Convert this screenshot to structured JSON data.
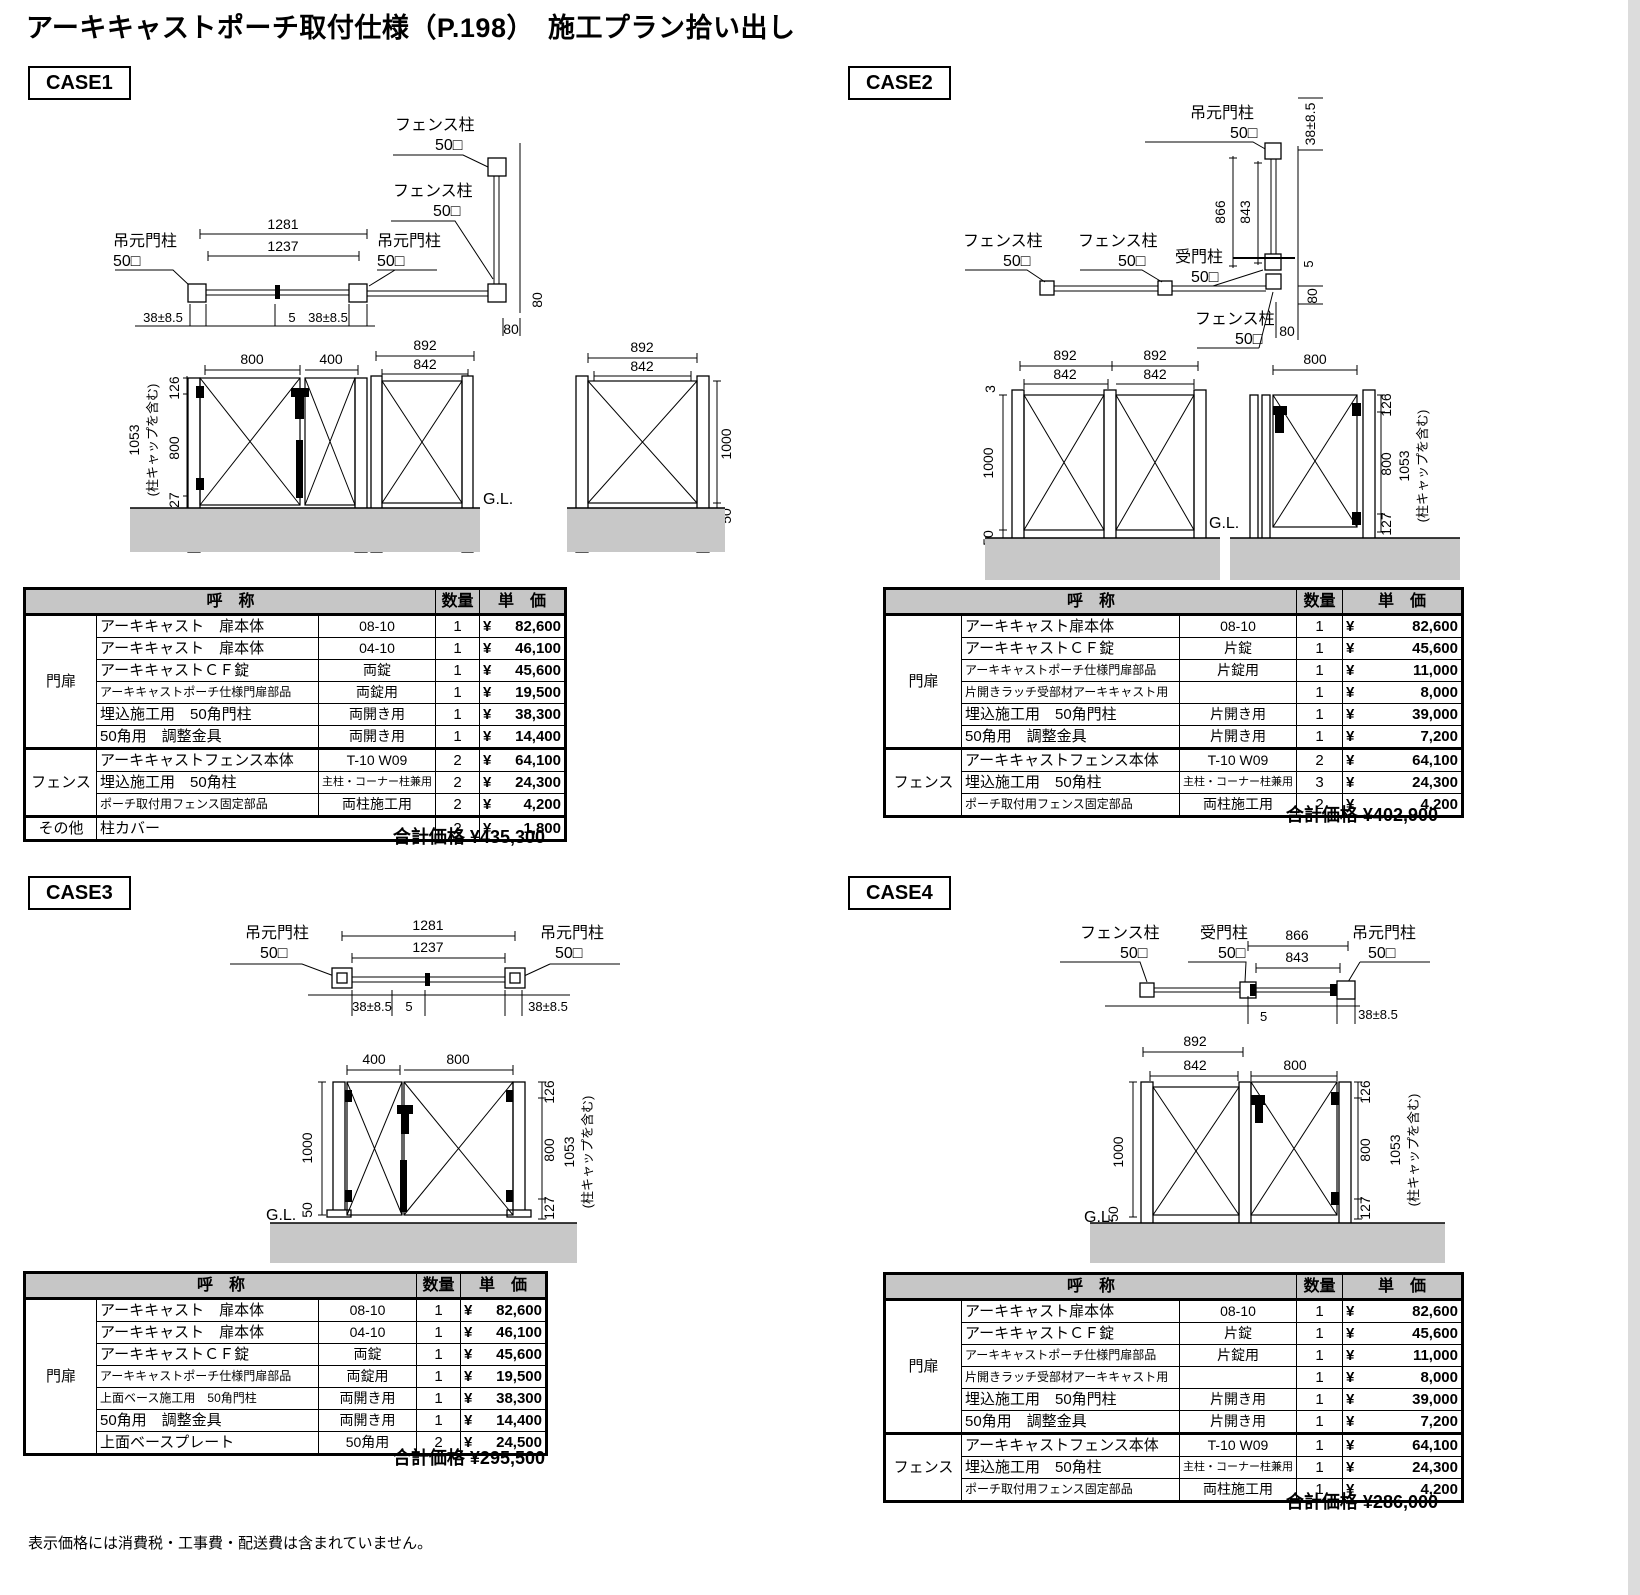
{
  "title": "アーキキャストポーチ取付仕様（P.198）　施工プラン拾い出し",
  "footnote": "表示価格には消費税・工事費・配送費は含まれていません。",
  "table": {
    "name_header": "呼　称",
    "qty_header": "数量",
    "price_header": "単　価",
    "total_label": "合計価格",
    "yen": "¥"
  },
  "dw": {
    "hinge_post": "吊元門柱",
    "fence_post": "フェンス柱",
    "recv_post": "受門柱",
    "sq50": "50□",
    "gl": "G.L.",
    "cap_note": "(柱キャップを含む)",
    "d1281": "1281",
    "d1237": "1237",
    "tol": "38±8.5",
    "d5": "5",
    "d80": "80",
    "d892": "892",
    "d842": "842",
    "d800": "800",
    "d400": "400",
    "d1000": "1000",
    "d50": "50",
    "d126": "126",
    "d127": "127",
    "d1053": "1053",
    "d866": "866",
    "d843": "843",
    "d3": "3"
  },
  "case1": {
    "label": "CASE1",
    "total": "¥435,300",
    "rows": [
      {
        "cat": "門扉",
        "name": "アーキキャスト　扉本体",
        "spec": "08-10",
        "qty": "1",
        "amt": "82,600"
      },
      {
        "name": "アーキキャスト　扉本体",
        "spec": "04-10",
        "qty": "1",
        "amt": "46,100"
      },
      {
        "name": "アーキキャストＣＦ錠",
        "spec": "両錠",
        "qty": "1",
        "amt": "45,600"
      },
      {
        "name": "アーキキャストポーチ仕様門扉部品",
        "spec": "両錠用",
        "qty": "1",
        "amt": "19,500"
      },
      {
        "name": "埋込施工用　50角門柱",
        "spec": "両開き用",
        "qty": "1",
        "amt": "38,300"
      },
      {
        "name": "50角用　調整金具",
        "spec": "両開き用",
        "qty": "1",
        "amt": "14,400"
      },
      {
        "cat": "フェンス",
        "name": "アーキキャストフェンス本体",
        "spec": "T-10 W09",
        "qty": "2",
        "amt": "64,100"
      },
      {
        "name": "埋込施工用　50角柱",
        "spec": "主柱・コーナー柱兼用",
        "qty": "2",
        "amt": "24,300"
      },
      {
        "name": "ポーチ取付用フェンス固定部品",
        "spec": "両柱施工用",
        "qty": "2",
        "amt": "4,200"
      },
      {
        "cat": "その他",
        "name": "柱カバー",
        "spec": "",
        "qty": "2",
        "amt": "1,800"
      }
    ]
  },
  "case2": {
    "label": "CASE2",
    "total": "¥402,900",
    "rows": [
      {
        "cat": "門扉",
        "name": "アーキキャスト扉本体",
        "spec": "08-10",
        "qty": "1",
        "amt": "82,600"
      },
      {
        "name": "アーキキャストＣＦ錠",
        "spec": "片錠",
        "qty": "1",
        "amt": "45,600"
      },
      {
        "name": "アーキキャストポーチ仕様門扉部品",
        "spec": "片錠用",
        "qty": "1",
        "amt": "11,000"
      },
      {
        "name": "片開きラッチ受部材アーキキャスト用",
        "spec": "",
        "qty": "1",
        "amt": "8,000"
      },
      {
        "name": "埋込施工用　50角門柱",
        "spec": "片開き用",
        "qty": "1",
        "amt": "39,000"
      },
      {
        "name": "50角用　調整金具",
        "spec": "片開き用",
        "qty": "1",
        "amt": "7,200"
      },
      {
        "cat": "フェンス",
        "name": "アーキキャストフェンス本体",
        "spec": "T-10 W09",
        "qty": "2",
        "amt": "64,100"
      },
      {
        "name": "埋込施工用　50角柱",
        "spec": "主柱・コーナー柱兼用",
        "qty": "3",
        "amt": "24,300"
      },
      {
        "name": "ポーチ取付用フェンス固定部品",
        "spec": "両柱施工用",
        "qty": "2",
        "amt": "4,200"
      }
    ]
  },
  "case3": {
    "label": "CASE3",
    "total": "¥295,500",
    "rows": [
      {
        "cat": "門扉",
        "name": "アーキキャスト　扉本体",
        "spec": "08-10",
        "qty": "1",
        "amt": "82,600"
      },
      {
        "name": "アーキキャスト　扉本体",
        "spec": "04-10",
        "qty": "1",
        "amt": "46,100"
      },
      {
        "name": "アーキキャストＣＦ錠",
        "spec": "両錠",
        "qty": "1",
        "amt": "45,600"
      },
      {
        "name": "アーキキャストポーチ仕様門扉部品",
        "spec": "両錠用",
        "qty": "1",
        "amt": "19,500"
      },
      {
        "name": "上面ベース施工用　50角門柱",
        "spec": "両開き用",
        "qty": "1",
        "amt": "38,300"
      },
      {
        "name": "50角用　調整金具",
        "spec": "両開き用",
        "qty": "1",
        "amt": "14,400"
      },
      {
        "name": "上面ベースプレート",
        "spec": "50角用",
        "qty": "2",
        "amt": "24,500"
      }
    ]
  },
  "case4": {
    "label": "CASE4",
    "total": "¥286,000",
    "rows": [
      {
        "cat": "門扉",
        "name": "アーキキャスト扉本体",
        "spec": "08-10",
        "qty": "1",
        "amt": "82,600"
      },
      {
        "name": "アーキキャストＣＦ錠",
        "spec": "片錠",
        "qty": "1",
        "amt": "45,600"
      },
      {
        "name": "アーキキャストポーチ仕様門扉部品",
        "spec": "片錠用",
        "qty": "1",
        "amt": "11,000"
      },
      {
        "name": "片開きラッチ受部材アーキキャスト用",
        "spec": "",
        "qty": "1",
        "amt": "8,000"
      },
      {
        "name": "埋込施工用　50角門柱",
        "spec": "片開き用",
        "qty": "1",
        "amt": "39,000"
      },
      {
        "name": "50角用　調整金具",
        "spec": "片開き用",
        "qty": "1",
        "amt": "7,200"
      },
      {
        "cat": "フェンス",
        "name": "アーキキャストフェンス本体",
        "spec": "T-10 W09",
        "qty": "1",
        "amt": "64,100"
      },
      {
        "name": "埋込施工用　50角柱",
        "spec": "主柱・コーナー柱兼用",
        "qty": "1",
        "amt": "24,300"
      },
      {
        "name": "ポーチ取付用フェンス固定部品",
        "spec": "両柱施工用",
        "qty": "1",
        "amt": "4,200"
      }
    ]
  }
}
